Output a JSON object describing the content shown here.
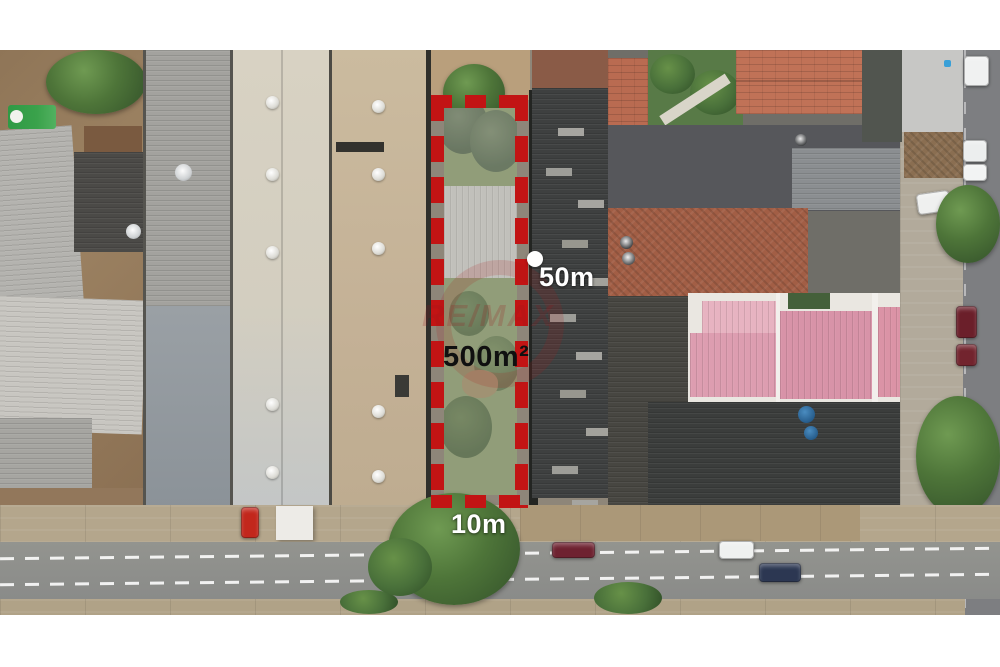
{
  "annotations": {
    "area_label": "500m²",
    "depth_label": "50m",
    "frontage_label": "10m"
  },
  "watermark": {
    "text": "RE/MAX"
  },
  "colors": {
    "boundary_red": "#c21414",
    "area_label_color": "#101010",
    "side_label_color": "#ffffff",
    "watermark_red": "#b5191d",
    "lot_grass_green": "#7b8a5e",
    "pink_roof": "#d893a8",
    "dark_roof": "#3e4040"
  }
}
